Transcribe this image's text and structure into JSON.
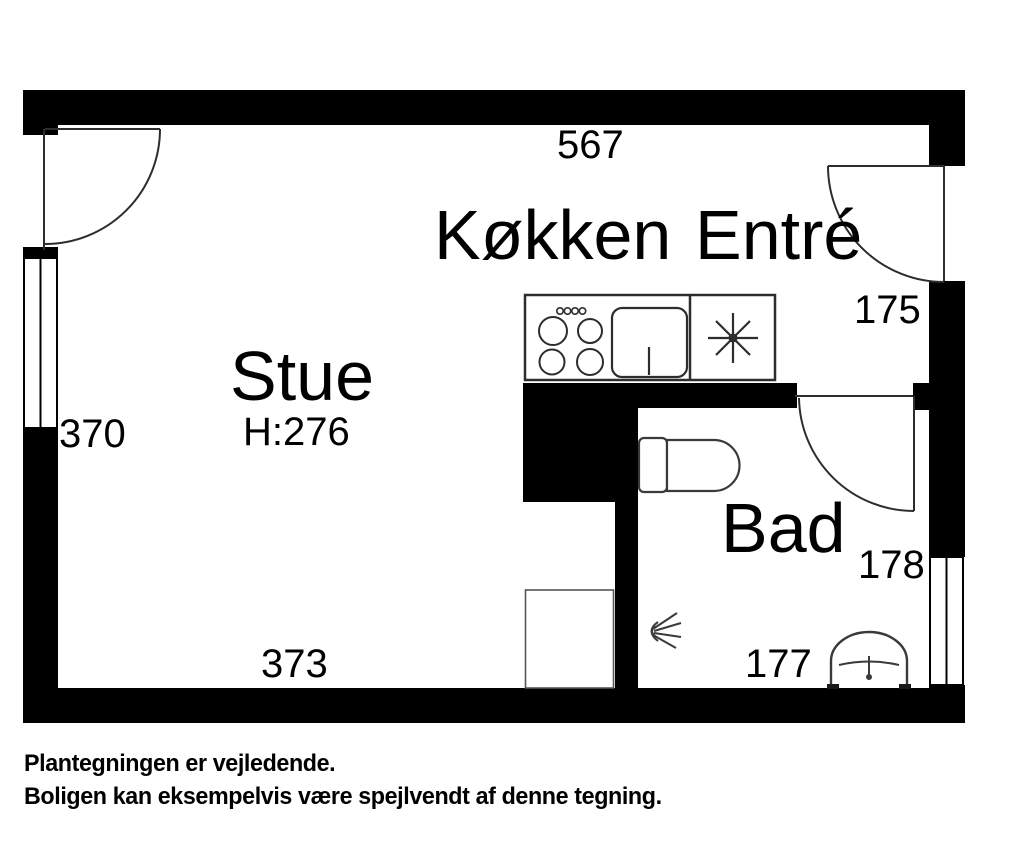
{
  "floorplan": {
    "rooms": {
      "stue": {
        "label": "Stue",
        "ceiling_height": "H:276"
      },
      "kokken": {
        "label": "Køkken"
      },
      "entre": {
        "label": "Entré"
      },
      "bad": {
        "label": "Bad"
      }
    },
    "dimensions": {
      "top_width": "567",
      "left_height": "370",
      "bottom_width": "373",
      "entre_width": "175",
      "bad_height": "178",
      "bad_width": "177"
    },
    "symbols": [
      "stove-burners-symbol",
      "kitchen-sink-symbol",
      "cooktop-star-symbol",
      "toilet-symbol",
      "shower-head-symbol",
      "washbasin-symbol",
      "door-swing-symbol",
      "window-symbol"
    ],
    "colors": {
      "wall": "#000000",
      "line": "#2d2d2d",
      "background": "#ffffff"
    }
  },
  "footer": {
    "line1": "Plantegningen er vejledende.",
    "line2": "Boligen kan eksempelvis være spejlvendt af denne tegning."
  }
}
